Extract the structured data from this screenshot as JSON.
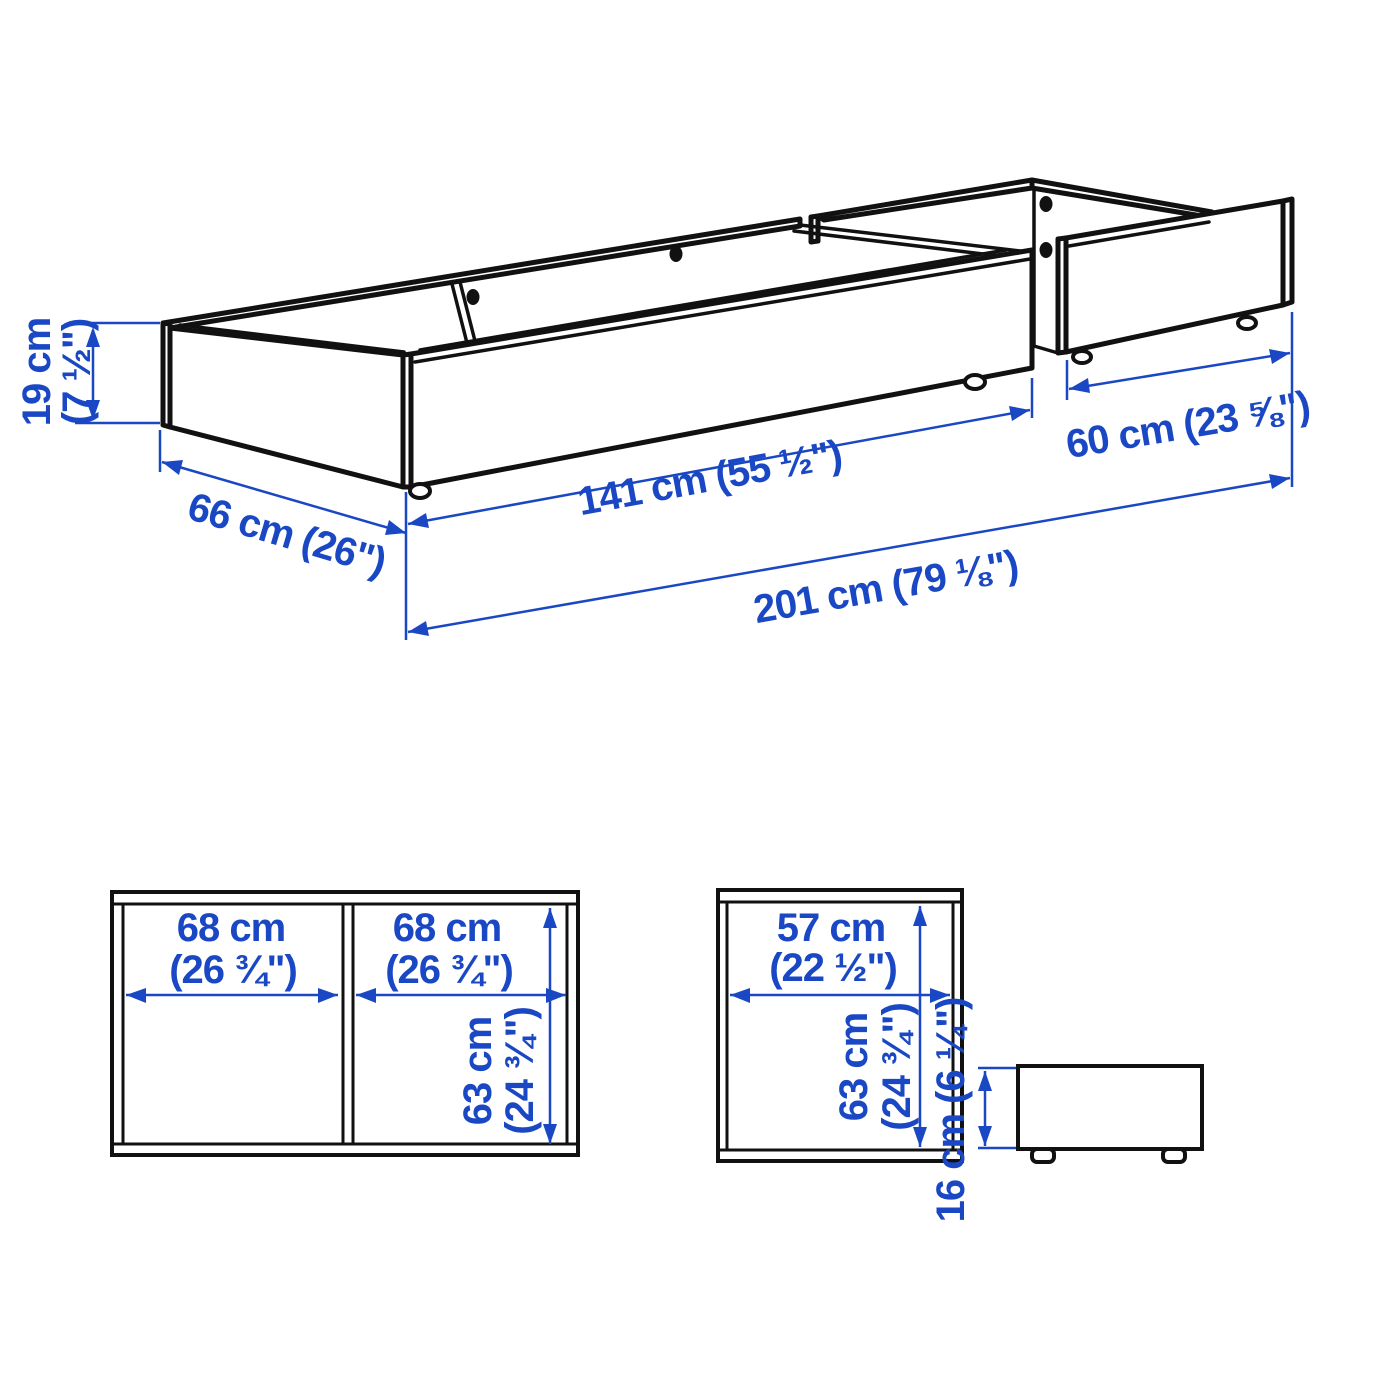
{
  "title": "Under-bed storage boxes dimension diagram",
  "colors": {
    "dimension_blue": "#1a47c4",
    "line_black": "#111111",
    "background": "#ffffff"
  },
  "iso_view": {
    "height": {
      "metric": "19 cm",
      "imperial": "(7 ½\")"
    },
    "depth": {
      "metric": "66 cm",
      "imperial": "(26\")"
    },
    "long_box_length": {
      "metric": "141 cm",
      "imperial": "(55 ½\")"
    },
    "short_box_length": {
      "metric": "60 cm",
      "imperial": "(23 ⅝\")"
    },
    "total_length": {
      "metric": "201 cm",
      "imperial": "(79 ⅛\")"
    }
  },
  "plan_views": {
    "long_box": {
      "compartment_1_width": {
        "metric": "68 cm",
        "imperial": "(26 ¾\")"
      },
      "compartment_2_width": {
        "metric": "68 cm",
        "imperial": "(26 ¾\")"
      },
      "inner_depth": {
        "metric": "63 cm",
        "imperial": "(24 ¾\")"
      }
    },
    "short_box": {
      "inner_width": {
        "metric": "57 cm",
        "imperial": "(22 ½\")"
      },
      "inner_depth": {
        "metric": "63 cm",
        "imperial": "(24 ¾\")"
      }
    },
    "side_view": {
      "height": {
        "metric": "16 cm",
        "imperial": "(6 ¼\")"
      }
    }
  }
}
